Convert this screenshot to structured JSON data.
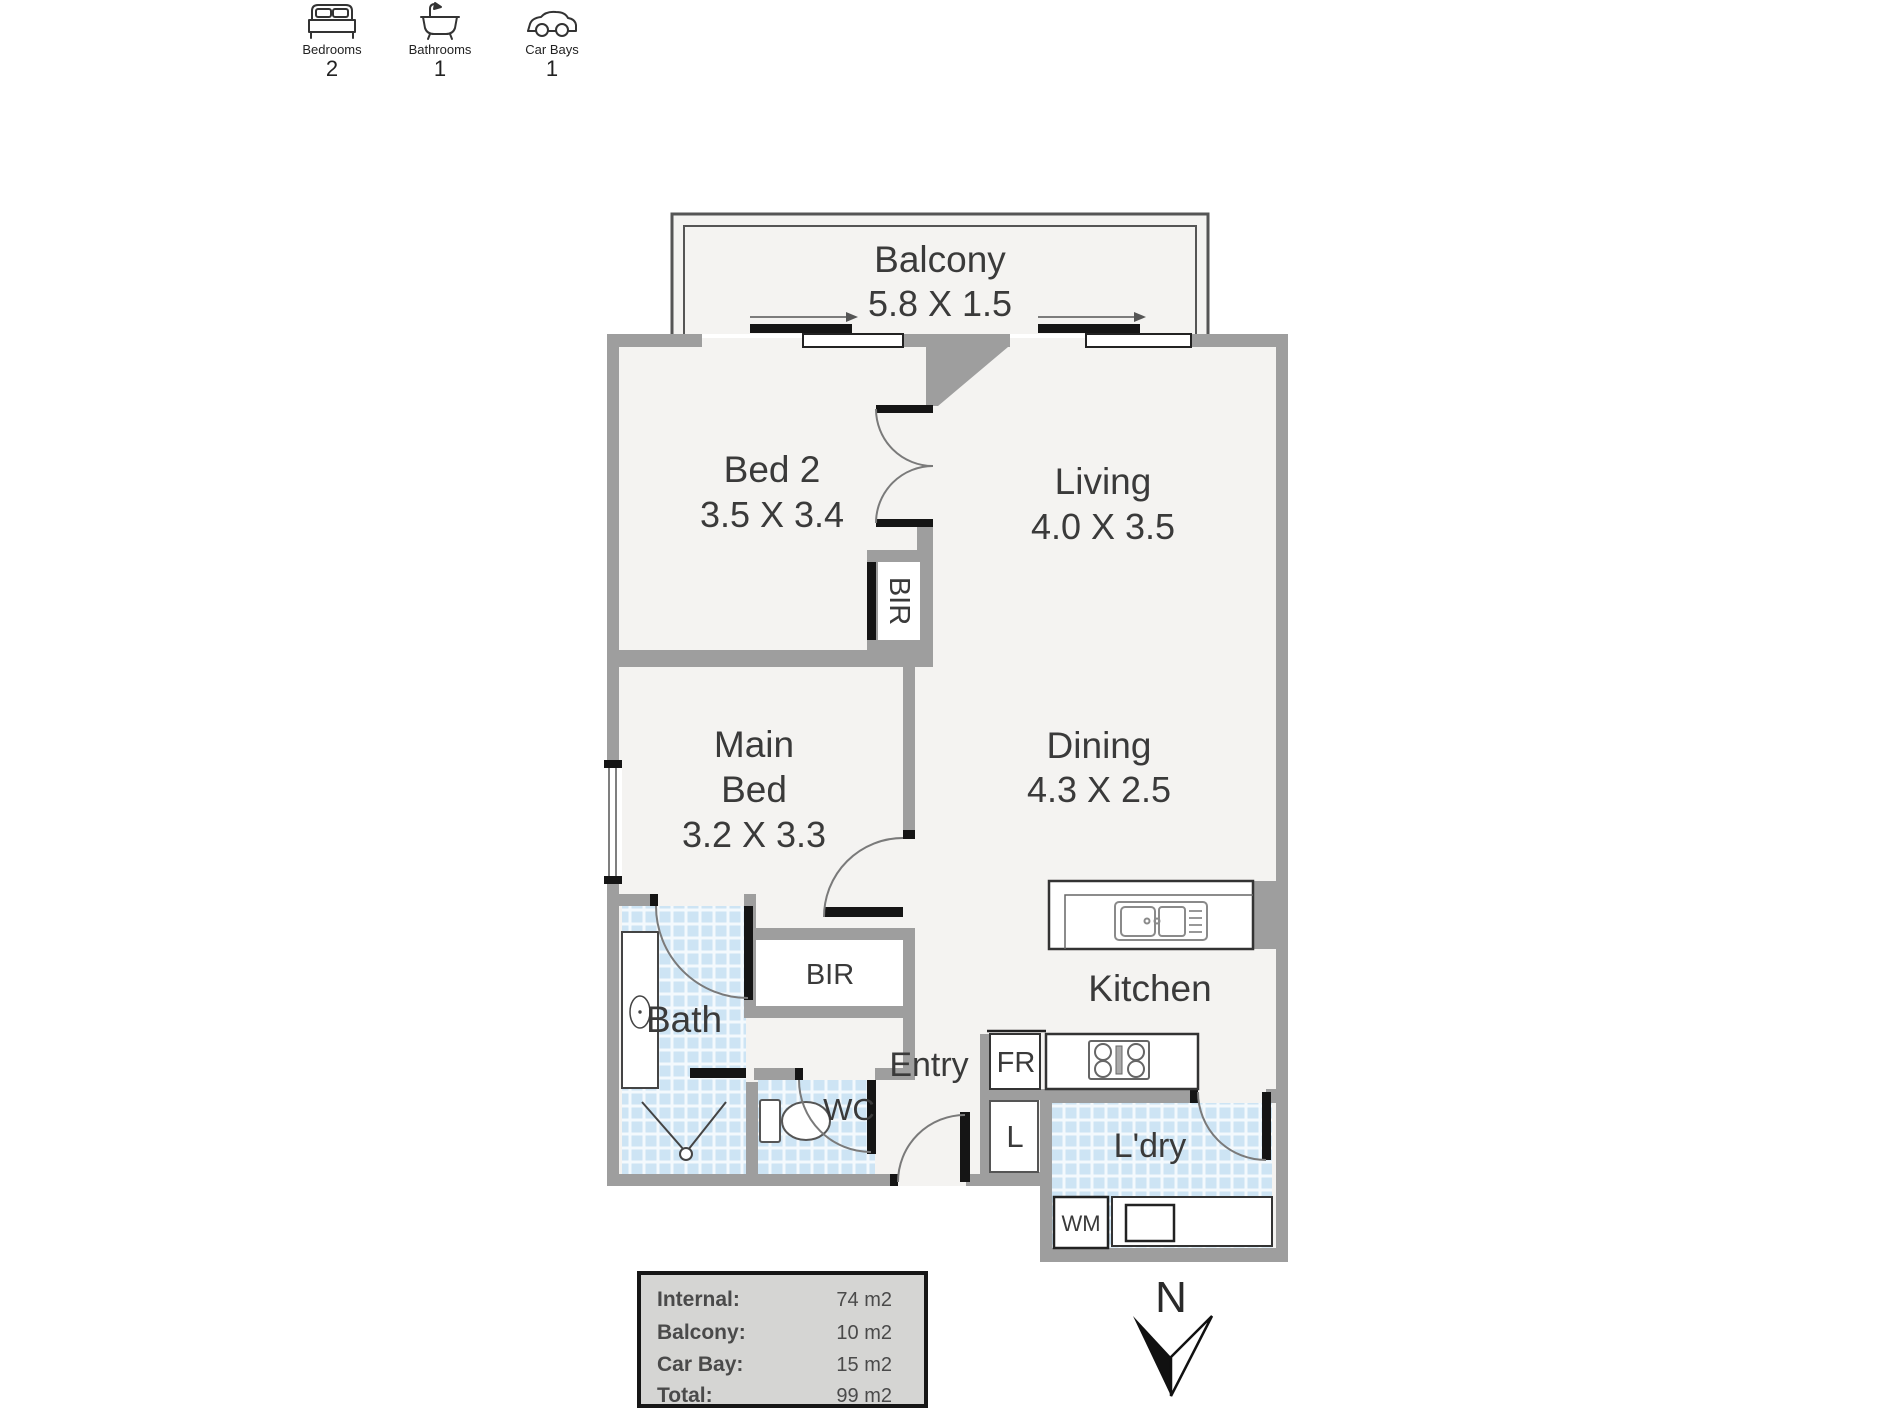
{
  "summary_icons": {
    "bedrooms_label": "Bedrooms",
    "bedrooms_value": "2",
    "bathrooms_label": "Bathrooms",
    "bathrooms_value": "1",
    "carbays_label": "Car Bays",
    "carbays_value": "1"
  },
  "plan": {
    "balcony_name": "Balcony",
    "balcony_dims": "5.8 X 1.5",
    "bed2_name": "Bed 2",
    "bed2_dims": "3.5 X 3.4",
    "living_name": "Living",
    "living_dims": "4.0 X 3.5",
    "main_bed_line1": "Main",
    "main_bed_line2": "Bed",
    "main_bed_dims": "3.2 X 3.3",
    "dining_name": "Dining",
    "dining_dims": "4.3 X 2.5",
    "kitchen_name": "Kitchen",
    "bath_name": "Bath",
    "entry_name": "Entry",
    "wc_name": "WC",
    "laundry_name": "L'dry",
    "bir_label": "BIR",
    "fridge_label": "FR",
    "linen_label": "L",
    "washing_machine_label": "WM"
  },
  "area_table": {
    "rows": [
      {
        "label": "Internal:",
        "value": "74 m2"
      },
      {
        "label": "Balcony:",
        "value": "10 m2"
      },
      {
        "label": "Car Bay:",
        "value": "15 m2"
      },
      {
        "label": "Total:",
        "value": "99 m2"
      }
    ]
  },
  "compass": {
    "north_label": "N"
  },
  "colors": {
    "wall": "#9e9e9e",
    "floor": "#f4f3f1",
    "tile_blue": "#cde4f4",
    "text": "#3a3a3a",
    "legend_bg": "#d5d5d3",
    "door_black": "#151515"
  }
}
